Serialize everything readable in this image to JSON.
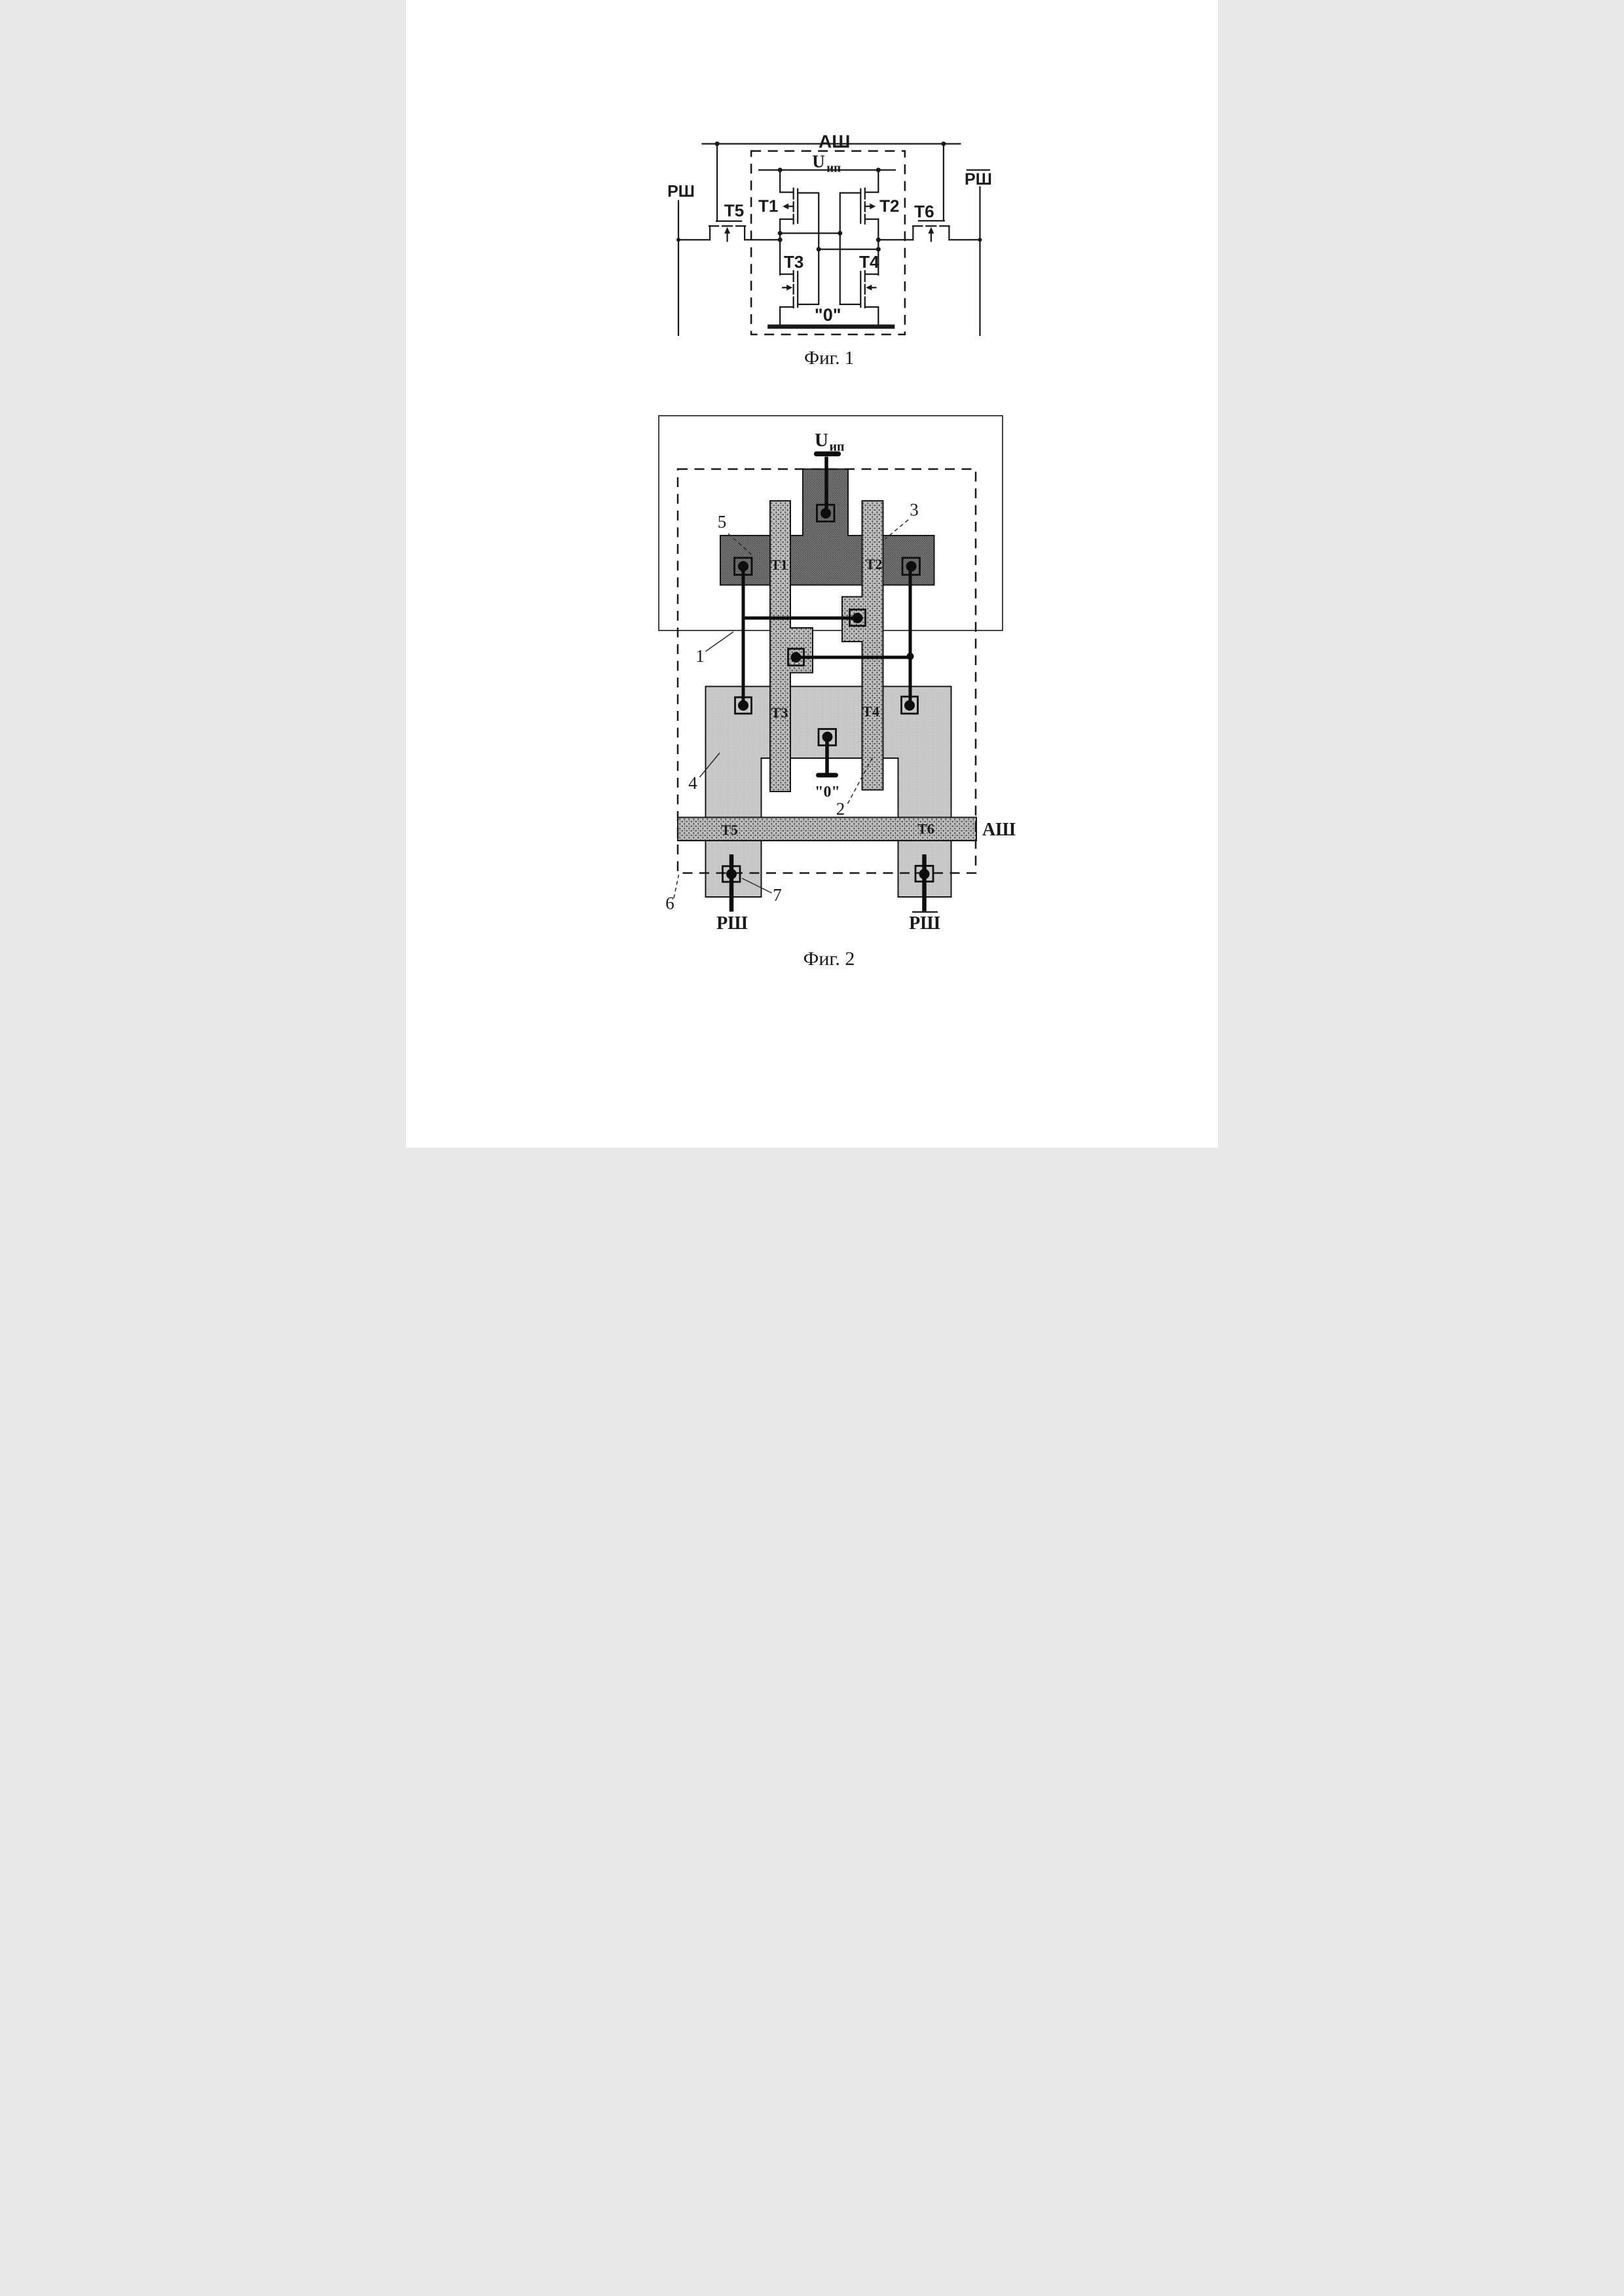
{
  "colors": {
    "c-bg": "#ffffff",
    "c-ink": "#1a1a1a",
    "c-metal": "#0d0d0d",
    "c-region5": "#757575",
    "c-region5-dot": "#3c3c3c",
    "c-poly": "#bfbfbf",
    "c-poly-dot": "#4a4a4a",
    "c-region4": "#c9c9c9",
    "c-region4-dot": "#b5b5b5"
  },
  "figure1": {
    "caption": "Фиг. 1",
    "labels": {
      "address_line": "АШ",
      "supply_u": "U",
      "supply_sub": "ип",
      "t1": "Т1",
      "t2": "Т2",
      "t3": "Т3",
      "t4": "Т4",
      "t5": "Т5",
      "t6": "Т6",
      "ground": "\"0\"",
      "bitline": "РШ",
      "bitline_inverted": "РШ"
    }
  },
  "figure2": {
    "caption": "Фиг. 2",
    "labels": {
      "supply_u": "U",
      "supply_sub": "ип",
      "t1": "Т1",
      "t2": "Т2",
      "t3": "Т3",
      "t4": "Т4",
      "t5": "Т5",
      "t6": "Т6",
      "ground": "\"0\"",
      "address_line": "АШ",
      "bitline": "РШ",
      "bitline_inverted": "РШ"
    },
    "callouts": {
      "n1": "1",
      "n2": "2",
      "n3": "3",
      "n4": "4",
      "n5": "5",
      "n6": "6",
      "n7": "7"
    }
  }
}
